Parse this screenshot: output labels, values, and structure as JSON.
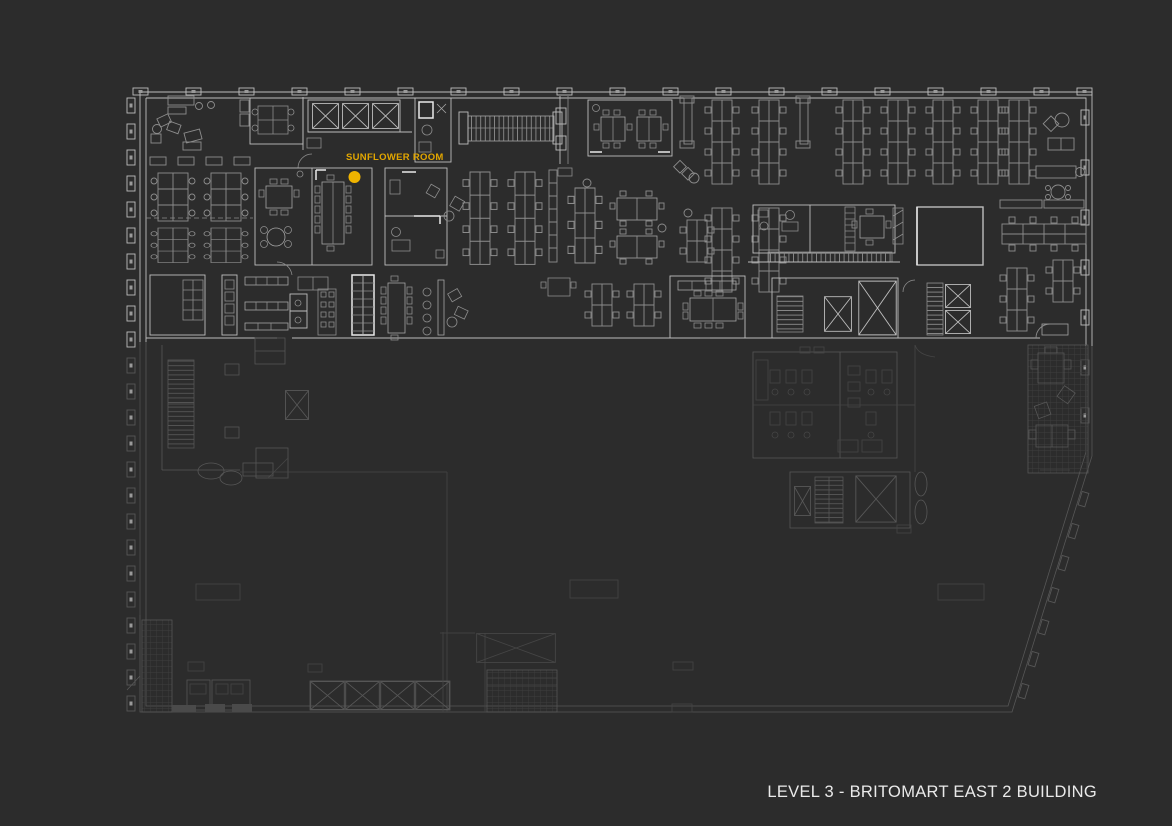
{
  "floor_plan": {
    "title": "LEVEL 3 - BRITOMART EAST 2 BUILDING",
    "highlighted_room": {
      "label": "SUNFLOWER ROOM",
      "marker_shape": "dot"
    },
    "colors": {
      "background": "#2c2c2c",
      "accent_yellow": "#e2a600",
      "marker_yellow": "#f0b400",
      "title_text": "#eaeaea",
      "wall": "#bdbdbd",
      "wall_bright": "#e9e9e9",
      "furniture": "#8d8d8d",
      "furniture_bright": "#a6a6a6",
      "faint": "#575757",
      "very_faint": "#454545",
      "column_fill": "#9a9a9a"
    }
  }
}
